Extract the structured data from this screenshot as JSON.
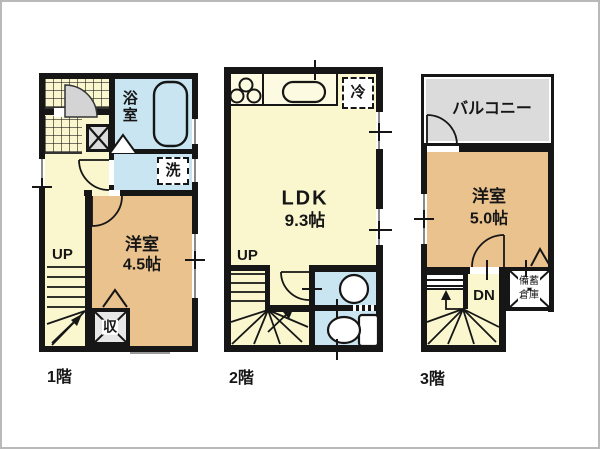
{
  "plan_title": "3-story floor plan",
  "colors": {
    "wall": "#161616",
    "western_room": "#EAC28E",
    "hall": "#FAF7CF",
    "wet_area": "#C9E5F2",
    "balcony": "#DBDBDB"
  },
  "floor1": {
    "label": "1階",
    "bathroom": "浴室",
    "laundry": "洗",
    "room_name": "洋室",
    "room_size": "4.5帖",
    "stairs": "UP",
    "closet": "収"
  },
  "floor2": {
    "label": "2階",
    "refrigerator": "冷",
    "ldk_name": "LDK",
    "ldk_size": "9.3帖",
    "stairs": "UP"
  },
  "floor3": {
    "label": "3階",
    "balcony": "バルコニー",
    "room_name": "洋室",
    "room_size": "5.0帖",
    "stairs": "DN",
    "storage_line1": "備蓄",
    "storage_line2": "倉庫"
  }
}
